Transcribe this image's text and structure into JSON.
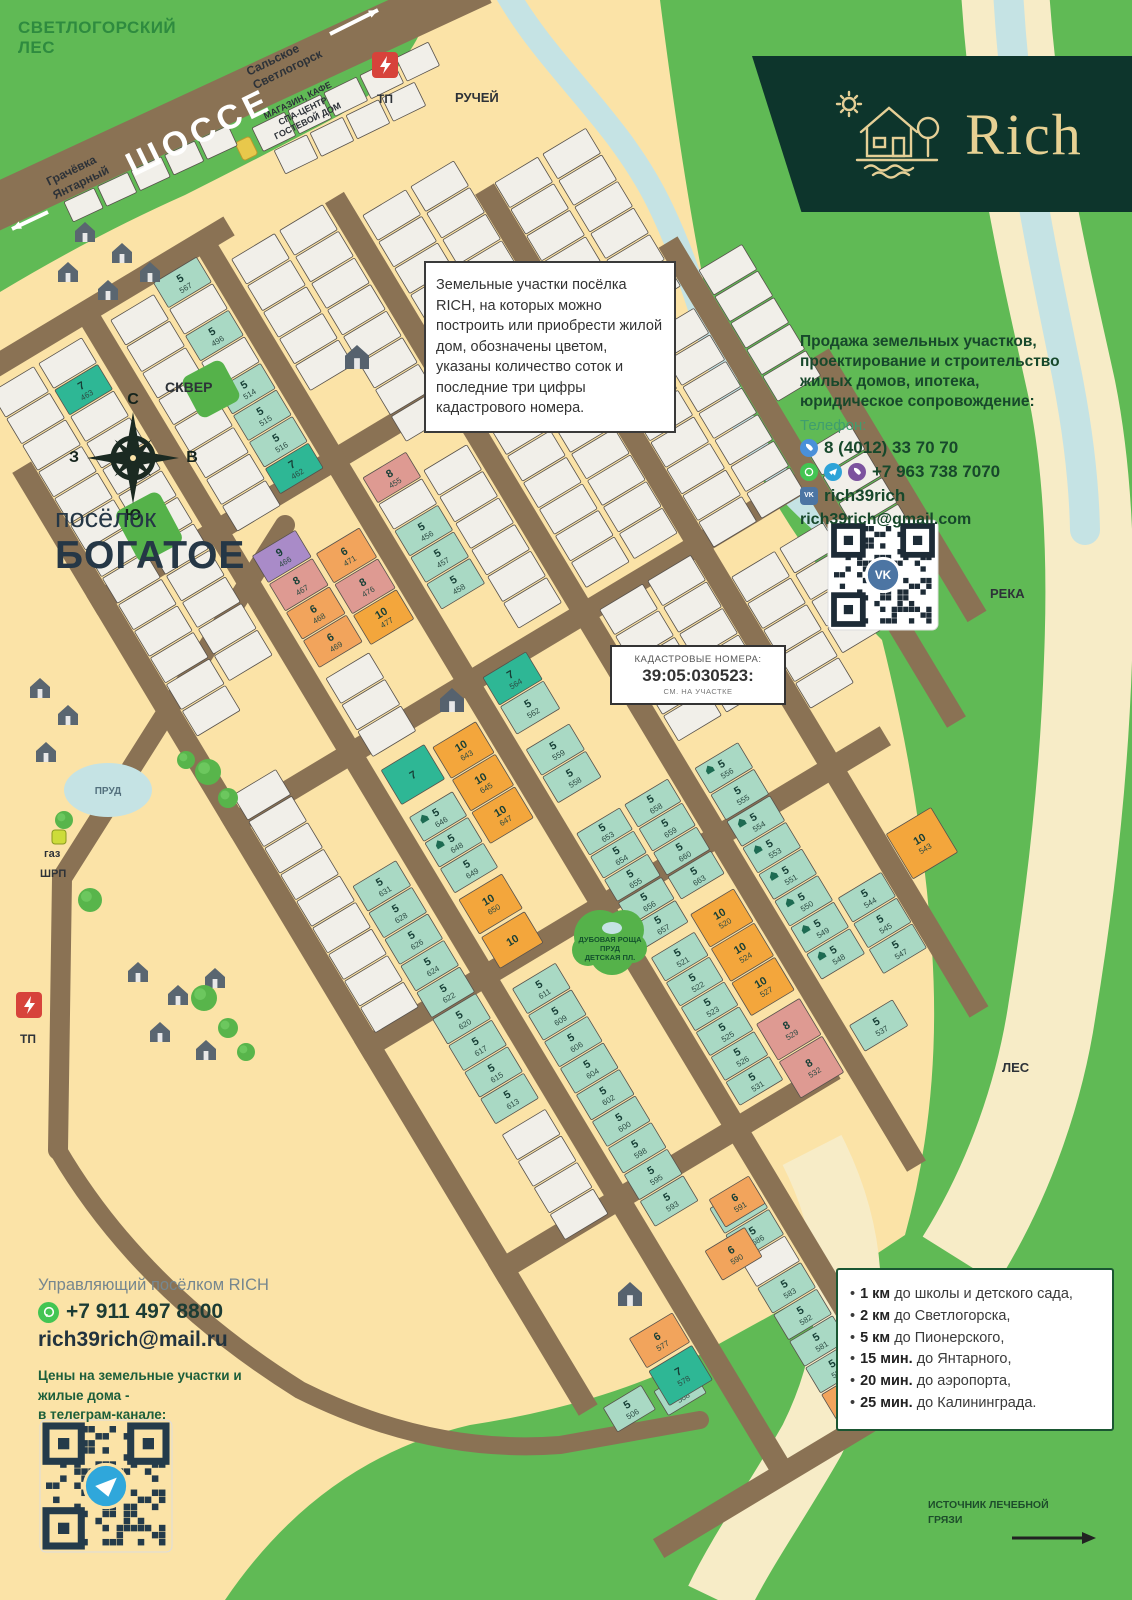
{
  "branding": {
    "name": "Rich"
  },
  "top": {
    "forest": [
      "СВЕТЛОГОРСКИЙ",
      "ЛЕС"
    ],
    "highway": "ШОССЕ",
    "dir_ne": [
      "Сальское",
      "Светлогорск"
    ],
    "dir_sw": [
      "Грачёвка",
      "Янтарный"
    ],
    "tp": "ТП",
    "stream": "РУЧЕЙ",
    "services": [
      "МАГАЗИН, КАФЕ",
      "СПА-ЦЕНТР",
      "ГОСТЕВОЙ ДОМ"
    ]
  },
  "left": {
    "skver": "СКВЕР",
    "village": [
      "посёлок",
      "БОГАТОЕ"
    ],
    "pond": "ПРУД",
    "gas": [
      "газ",
      "ШРП"
    ],
    "tp": "ТП",
    "compass": {
      "n": "С",
      "e": "В",
      "s": "Ю",
      "w": "З"
    }
  },
  "right": {
    "river": "РЕКА",
    "forest": "ЛЕС",
    "mud": [
      "ИСТОЧНИК ЛЕЧЕБНОЙ",
      "ГРЯЗИ"
    ]
  },
  "grove": [
    "ДУБОВАЯ РОЩА",
    "ПРУД",
    "ДЕТСКАЯ ПЛ."
  ],
  "info_box": {
    "text": "Земельные участки посёлка RICH, на которых можно построить или приобрести жилой дом, обозначены цветом, указаны количество соток и последние три цифры кадастрового номера."
  },
  "cadastre": {
    "l1": "КАДАСТРОВЫЕ НОМЕРА:",
    "l2": "39:05:030523:",
    "l3": "СМ. НА УЧАСТКЕ"
  },
  "sales": {
    "lines": [
      "Продажа земельных участков,",
      "проектирование и строительство",
      "жилых домов, ипотека,",
      "юридическое сопровождение:"
    ],
    "phone_label": "Телефон:",
    "phone1": "8 (4012) 33 70 70",
    "phone2": "+7 963 738 7070",
    "vk": "rich39rich",
    "email": "rich39rich@gmail.com"
  },
  "manager": {
    "title": "Управляющий посёлком RICH",
    "phone": "+7 911 497 8800",
    "email": "rich39rich@mail.ru",
    "prices": [
      "Цены на земельные участки и",
      "жилые дома -",
      "в телеграм-канале:"
    ]
  },
  "distances": [
    {
      "b": "1 км",
      "t": "до школы и детского сада,"
    },
    {
      "b": "2 км",
      "t": "до Светлогорска,"
    },
    {
      "b": "5 км",
      "t": "до Пионерского,"
    },
    {
      "b": "15 мин.",
      "t": "до Янтарного,"
    },
    {
      "b": "20 мин.",
      "t": "до аэропорта,"
    },
    {
      "b": "25 мин.",
      "t": "до Калининграда."
    }
  ],
  "colors": {
    "t5": "#A9D9C4",
    "t7": "#2EB795",
    "p8": "#DE9A92",
    "o6": "#F2A45C",
    "o10": "#F3A63C",
    "pu9": "#A98BC8",
    "w": "#F1EFE9",
    "road": "#8A7254",
    "green": "#60BA55",
    "cream": "#FBE3A7",
    "water": "#C5E3E4",
    "sand": "#F7ECC7",
    "dark_banner": "#0D352C",
    "gold": "#E7D193"
  },
  "map": {
    "origin": [
      200,
      430
    ],
    "angle": -31,
    "roads": {
      "v": [
        [
          -172,
          -60,
          1040
        ],
        [
          -37,
          -160,
          1200
        ],
        [
          100,
          -160,
          1200
        ],
        [
          235,
          -130,
          1000
        ],
        [
          368,
          -60,
          900
        ],
        [
          498,
          80,
          640
        ],
        [
          570,
          254,
          560
        ]
      ],
      "h": [
        [
          -160,
          -183,
          130
        ],
        [
          95,
          -183,
          440
        ],
        [
          355,
          -183,
          500
        ],
        [
          615,
          -183,
          430
        ],
        [
          875,
          -183,
          215
        ],
        [
          1195,
          -183,
          120
        ]
      ]
    },
    "strips": [
      {
        "x": -160,
        "y": -140,
        "n": 13
      },
      {
        "x": -160,
        "y": 330,
        "n": 9
      },
      {
        "x": -104,
        "y": -140,
        "plots": [
          0,
          [
            "7",
            "463",
            "t7"
          ],
          0,
          0,
          0,
          0,
          0,
          0,
          0,
          0,
          0,
          0
        ]
      },
      {
        "x": -104,
        "y": 470,
        "plots": [
          [
            "5",
            "631",
            "t5"
          ],
          [
            "5",
            "628",
            "t5"
          ],
          [
            "5",
            "626",
            "t5"
          ],
          [
            "5",
            "624",
            "t5"
          ],
          [
            "5",
            "622",
            "t5"
          ],
          [
            "5",
            "620",
            "t5"
          ],
          [
            "5",
            "617",
            "t5"
          ],
          [
            "5",
            "615",
            "t5"
          ],
          [
            "5",
            "613",
            "t5"
          ]
        ]
      },
      {
        "x": -104,
        "y": 760,
        "n": 4
      },
      {
        "x": -20,
        "y": -140,
        "n": 8
      },
      {
        "x": -20,
        "y": 135,
        "ph": 33,
        "plots": [
          [
            "9",
            "466",
            "pu9"
          ],
          [
            "8",
            "467",
            "p8"
          ],
          [
            "6",
            "468",
            "o6"
          ],
          [
            "6",
            "469",
            "o6"
          ]
        ]
      },
      {
        "x": -20,
        "y": 278,
        "n": 3
      },
      {
        "x": -20,
        "y": 440,
        "ph": 30,
        "plots": [
          [
            "5",
            "646",
            "t5",
            1
          ],
          [
            "5",
            "648",
            "t5",
            1
          ],
          [
            "5",
            "649",
            "t5"
          ]
        ]
      },
      {
        "x": -20,
        "y": 640,
        "plots": [
          [
            "5",
            "611",
            "t5"
          ],
          [
            "5",
            "609",
            "t5"
          ],
          [
            "5",
            "606",
            "t5"
          ],
          [
            "5",
            "604",
            "t5"
          ],
          [
            "5",
            "602",
            "t5"
          ],
          [
            "5",
            "600",
            "t5"
          ],
          [
            "5",
            "598",
            "t5"
          ],
          [
            "5",
            "595",
            "t5"
          ],
          [
            "5",
            "593",
            "t5"
          ]
        ]
      },
      {
        "x": 36,
        "y": -150,
        "plots": [
          [
            "5",
            "567",
            "t5"
          ],
          0,
          [
            "5",
            "496",
            "t5"
          ],
          0,
          [
            "5",
            "514",
            "t5"
          ],
          [
            "5",
            "515",
            "t5"
          ],
          [
            "5",
            "516",
            "t5"
          ],
          [
            "7",
            "462",
            "t7"
          ]
        ]
      },
      {
        "x": 36,
        "y": 166,
        "ph": 36,
        "plots": [
          [
            "6",
            "471",
            "o6"
          ],
          [
            "8",
            "476",
            "p8"
          ],
          [
            "10",
            "477",
            "o10"
          ]
        ]
      },
      {
        "x": 36,
        "y": 392,
        "ph": 38,
        "plots": [
          [
            "10",
            "643",
            "o10"
          ],
          [
            "10",
            "645",
            "o10"
          ],
          [
            "10",
            "647",
            "o10"
          ]
        ]
      },
      {
        "x": 36,
        "y": 930,
        "plots": [
          [
            "5",
            "587",
            "t5"
          ],
          [
            "5",
            "586",
            "t5"
          ],
          0,
          [
            "5",
            "583",
            "t5"
          ],
          [
            "5",
            "582",
            "t5"
          ],
          [
            "5",
            "581",
            "t5"
          ],
          [
            "5",
            "580",
            "t5"
          ],
          [
            "6",
            "579",
            "o6"
          ]
        ]
      },
      {
        "x": 115,
        "y": -130,
        "n": 5
      },
      {
        "x": 115,
        "y": 125,
        "plots": [
          [
            "8",
            "455",
            "p8"
          ],
          0,
          [
            "5",
            "456",
            "t5"
          ],
          [
            "5",
            "457",
            "t5"
          ],
          [
            "5",
            "458",
            "t5"
          ]
        ]
      },
      {
        "x": 115,
        "y": 358,
        "ph": 34,
        "plots": [
          [
            "7",
            "564",
            "t7"
          ],
          [
            "5",
            "562",
            "t5"
          ]
        ]
      },
      {
        "x": 115,
        "y": 442,
        "ph": 32,
        "plots": [
          [
            "5",
            "559",
            "t5"
          ],
          [
            "5",
            "558",
            "t5"
          ]
        ]
      },
      {
        "x": 115,
        "y": 540,
        "ph": 27,
        "plots": [
          [
            "5",
            "653",
            "t5"
          ],
          [
            "5",
            "654",
            "t5"
          ],
          [
            "5",
            "655",
            "t5"
          ],
          [
            "5",
            "656",
            "t5"
          ],
          [
            "5",
            "657",
            "t5"
          ]
        ]
      },
      {
        "x": 115,
        "y": 685,
        "ph": 29,
        "plots": [
          [
            "5",
            "521",
            "t5"
          ],
          [
            "5",
            "522",
            "t5"
          ],
          [
            "5",
            "523",
            "t5"
          ],
          [
            "5",
            "525",
            "t5"
          ],
          [
            "5",
            "526",
            "t5"
          ],
          [
            "5",
            "531",
            "t5"
          ]
        ]
      },
      {
        "x": 171,
        "y": -130,
        "n": 8
      },
      {
        "x": 171,
        "y": 150,
        "n": 6
      },
      {
        "x": 171,
        "y": 540,
        "ph": 28,
        "plots": [
          [
            "5",
            "658",
            "t5"
          ],
          [
            "5",
            "659",
            "t5"
          ],
          [
            "5",
            "660",
            "t5"
          ],
          [
            "5",
            "663",
            "t5"
          ]
        ]
      },
      {
        "x": 171,
        "y": 668,
        "ph": 40,
        "plots": [
          [
            "10",
            "520",
            "o10"
          ],
          [
            "10",
            "524",
            "o10"
          ],
          [
            "10",
            "527",
            "o10"
          ]
        ]
      },
      {
        "x": 171,
        "y": 796,
        "ph": 44,
        "plots": [
          [
            "8",
            "529",
            "p8"
          ],
          [
            "8",
            "532",
            "p8"
          ]
        ]
      },
      {
        "x": 250,
        "y": -100,
        "n": 7
      },
      {
        "x": 250,
        "y": 150,
        "n": 6
      },
      {
        "x": 250,
        "y": 360,
        "n": 5
      },
      {
        "x": 250,
        "y": 545,
        "plots": [
          [
            "5",
            "556",
            "t5",
            1
          ],
          [
            "5",
            "555",
            "t5"
          ],
          [
            "5",
            "554",
            "t5",
            1
          ],
          [
            "5",
            "553",
            "t5",
            1
          ],
          [
            "5",
            "551",
            "t5",
            1
          ],
          [
            "5",
            "550",
            "t5",
            1
          ],
          [
            "5",
            "549",
            "t5",
            1
          ],
          [
            "5",
            "548",
            "t5",
            1
          ]
        ]
      },
      {
        "x": 306,
        "y": -100,
        "n": 7
      },
      {
        "x": 306,
        "y": 150,
        "n": 6
      },
      {
        "x": 306,
        "y": 360,
        "n": 5
      },
      {
        "x": 306,
        "y": 730,
        "ph": 30,
        "plots": [
          [
            "5",
            "544",
            "t5"
          ],
          [
            "5",
            "545",
            "t5"
          ],
          [
            "5",
            "547",
            "t5"
          ]
        ]
      },
      {
        "x": 380,
        "y": -60,
        "n": 6
      },
      {
        "x": 380,
        "y": 150,
        "n": 7
      },
      {
        "x": 380,
        "y": 400,
        "n": 5
      },
      {
        "x": 436,
        "y": -60,
        "n": 6
      },
      {
        "x": 436,
        "y": 150,
        "n": 7
      },
      {
        "x": 436,
        "y": 400,
        "n": 4
      },
      {
        "x": 510,
        "y": 120,
        "n": 5
      },
      {
        "x": 510,
        "y": 330,
        "n": 5
      }
    ],
    "singles": [
      {
        "x": -158,
        "y": 1046,
        "w": 44,
        "h": 28,
        "s": "5",
        "n": "506",
        "c": "t5"
      },
      {
        "x": -106,
        "y": 1058,
        "w": 44,
        "h": 28,
        "s": "5",
        "n": "508",
        "c": "t5"
      },
      {
        "x": -100,
        "y": 1000,
        "w": 50,
        "h": 34,
        "s": "6",
        "n": "577",
        "c": "o6"
      },
      {
        "x": -100,
        "y": 1038,
        "w": 50,
        "h": 40,
        "s": "7",
        "n": "578",
        "c": "t7"
      },
      {
        "x": -20,
        "y": 385,
        "w": 50,
        "h": 40,
        "s": "7",
        "n": "",
        "c": "t7"
      },
      {
        "x": -20,
        "y": 536,
        "w": 50,
        "h": 40,
        "s": "10",
        "n": "650",
        "c": "o10"
      },
      {
        "x": -20,
        "y": 580,
        "w": 50,
        "h": 36,
        "s": "10",
        "n": "",
        "c": "o10"
      },
      {
        "x": 10,
        "y": 964,
        "w": 46,
        "h": 34,
        "s": "6",
        "n": "590",
        "c": "o6"
      },
      {
        "x": 40,
        "y": 922,
        "w": 46,
        "h": 32,
        "s": "6",
        "n": "591",
        "c": "o6"
      },
      {
        "x": 250,
        "y": 845,
        "w": 50,
        "h": 30,
        "s": "5",
        "n": "537",
        "c": "t5"
      },
      {
        "x": 380,
        "y": 700,
        "w": 52,
        "h": 52,
        "s": "10",
        "n": "543",
        "c": "o10"
      }
    ]
  }
}
